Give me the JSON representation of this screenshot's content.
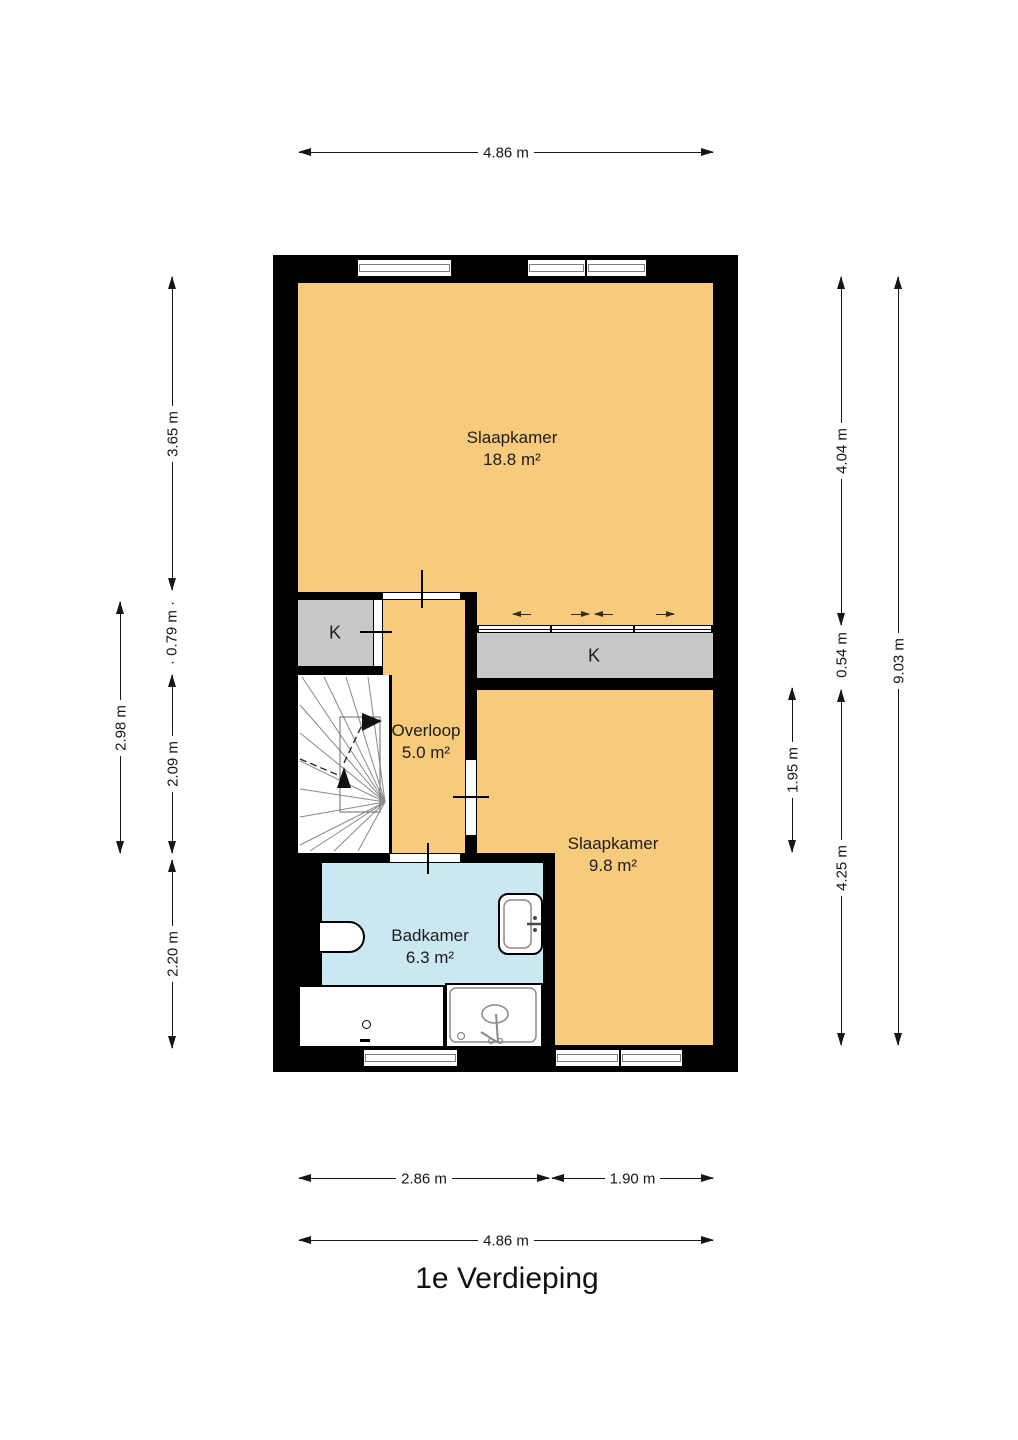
{
  "title": "1e Verdieping",
  "rooms": {
    "bedroom1": {
      "name": "Slaapkamer",
      "area": "18.8 m²"
    },
    "bedroom2": {
      "name": "Slaapkamer",
      "area": "9.8 m²"
    },
    "landing": {
      "name": "Overloop",
      "area": "5.0 m²"
    },
    "bathroom": {
      "name": "Badkamer",
      "area": "6.3 m²"
    },
    "closet_left": {
      "label": "K"
    },
    "closet_right": {
      "label": "K"
    }
  },
  "dimensions": {
    "top": {
      "width": "4.86 m"
    },
    "left": {
      "upper": "3.65 m",
      "closet": "· 0.79 m ·",
      "stairs": "2.09 m",
      "bathroom": "2.20 m",
      "middle": "2.98 m"
    },
    "right": {
      "upper": "4.04 m",
      "closet": "0.54 m",
      "door": "1.95 m",
      "lower": "4.25 m",
      "total": "9.03 m"
    },
    "bottom": {
      "left": "2.86 m",
      "right": "1.90 m",
      "total": "4.86 m"
    }
  },
  "colors": {
    "wall": "#000000",
    "floor": "#F8CA7C",
    "closet": "#C8C8C8",
    "bathroom": "#CBE7F1",
    "dimension_text": "#161616"
  }
}
